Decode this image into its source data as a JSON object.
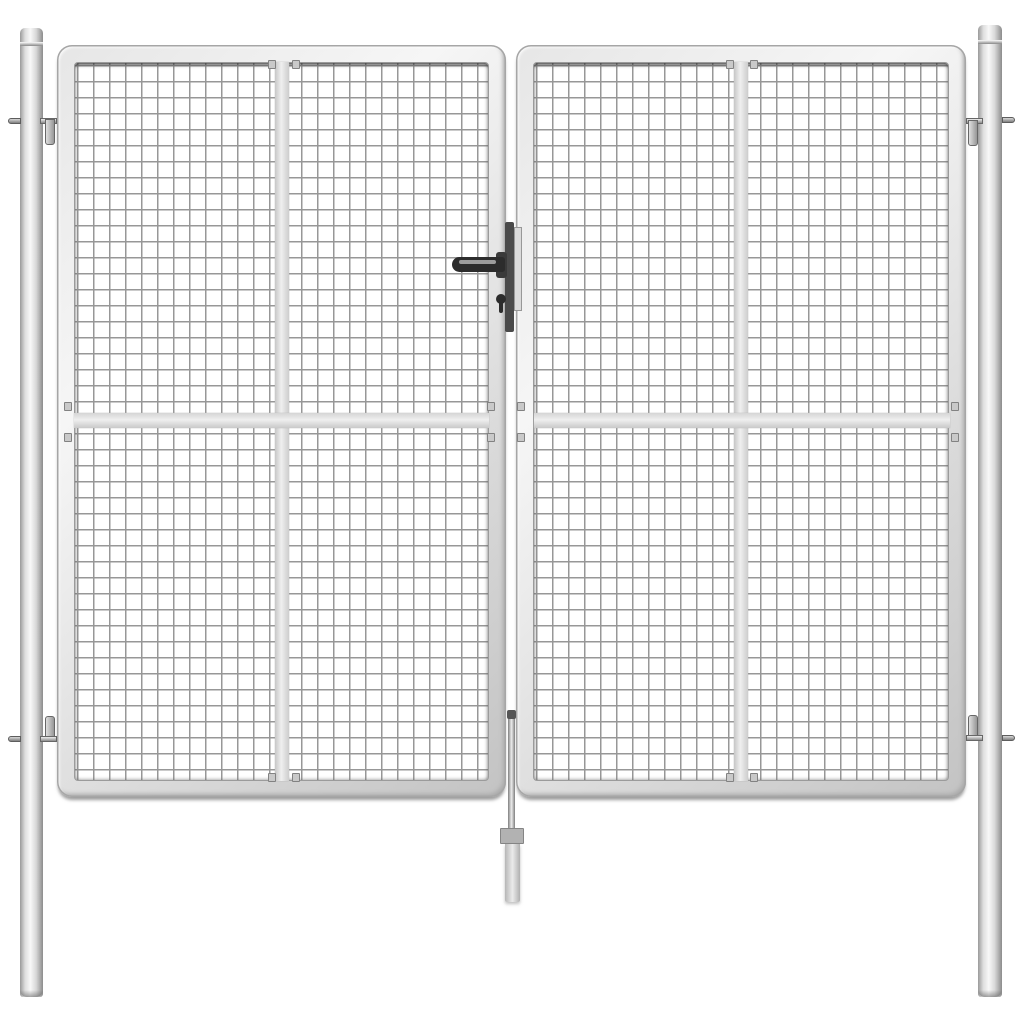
{
  "scene": {
    "type": "product-photo",
    "subject": "silver galvanised steel double garden gate with wire mesh infill",
    "background_color": "#ffffff",
    "objects": {
      "left_post": "round steel post with cap ring",
      "right_post": "round steel post with cap ring",
      "gate_leaf_left": "tube-framed mesh gate leaf",
      "gate_leaf_right": "tube-framed mesh gate leaf",
      "mesh_panel": "welded wire mesh, square cells",
      "vertical_brace_bar": "flat vertical reinforcement bar on each leaf",
      "horizontal_brace_bar": "flat horizontal reinforcement bar across both leaves",
      "hinges": "four adjustable hook hinges joining leaves to posts",
      "handle": "dark lever handle with cylinder keyhole",
      "lock_plate": "dark lock faceplate at meeting stiles",
      "strike_plate": "light strike plate on opposite leaf",
      "drop_rod": "centre drop bolt with ground sleeve"
    },
    "colors": {
      "background": "#ffffff",
      "steel_edge": "#a6a6a6",
      "steel_highlight": "#f6f6f6",
      "mesh_line": "#979797",
      "brace_bar": "#efefef",
      "hardware_dark": "#2c2c2c",
      "lock_plate": "#4a4a4a",
      "strike_plate": "#dadada"
    }
  }
}
